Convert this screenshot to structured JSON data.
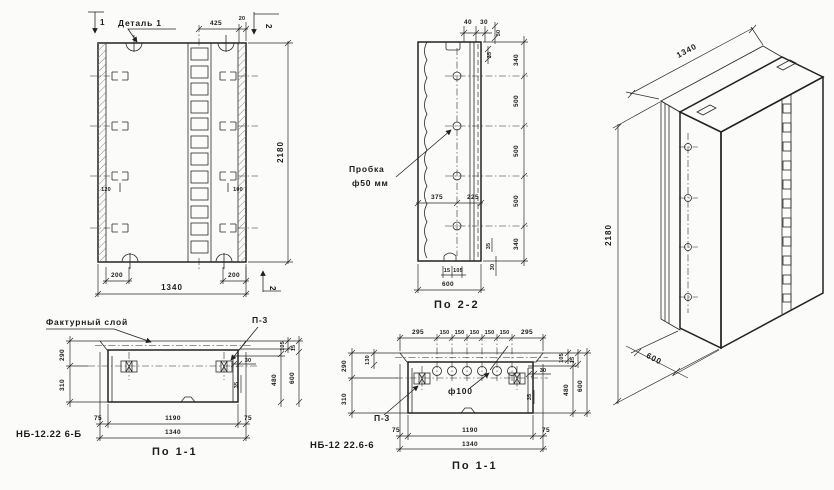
{
  "colors": {
    "ink": "#1f1f1f",
    "paper": "#fbfbfa"
  },
  "elevation": {
    "detail_callout": "Деталь 1",
    "dim_425": "425",
    "dim_20": "20",
    "mark_1": "1",
    "mark_2_top": "2",
    "mark_2_bottom": "2",
    "dim_height": "2180",
    "dim_200_left": "200",
    "dim_200_right": "200",
    "dim_width": "1340",
    "anchor_left": "120",
    "anchor_right": "100"
  },
  "section_2_2": {
    "title": "По 2-2",
    "plug_line1": "Пробка",
    "plug_line2": "ф50 мм",
    "dim_40": "40",
    "dim_30_top": "30",
    "dim_30_right": "30",
    "dim_35_right": "35",
    "chain": [
      "340",
      "500",
      "500",
      "500",
      "340"
    ],
    "dim_375": "375",
    "dim_225": "225",
    "dim_15": "15",
    "dim_105": "105",
    "dim_35_bot": "35",
    "dim_30_bot": "30",
    "dim_600": "600"
  },
  "section_1_1_b": {
    "model": "НБ-12.22 6-Б",
    "title": "По 1-1",
    "facing_callout": "Фактурный слой",
    "p3": "П-3",
    "dim_290": "290",
    "dim_310": "310",
    "dim_105": "105",
    "dim_15": "15",
    "dim_30": "30",
    "dim_35": "35",
    "dim_480": "480",
    "dim_600": "600",
    "dim_75_left": "75",
    "dim_1190": "1190",
    "dim_75_right": "75",
    "dim_1340": "1340"
  },
  "section_1_1_6": {
    "model": "НБ-12 22.6-6",
    "title": "По 1-1",
    "p3": "П-3",
    "hole": "ф100",
    "chain": [
      "295",
      "150",
      "150",
      "150",
      "150",
      "150",
      "295"
    ],
    "dim_290": "290",
    "dim_130": "130",
    "dim_310": "310",
    "dim_105": "105",
    "dim_15": "15",
    "dim_30": "30",
    "dim_35": "35",
    "dim_480": "480",
    "dim_600": "600",
    "dim_75_left": "75",
    "dim_1190": "1190",
    "dim_75_right": "75",
    "dim_1340": "1340"
  },
  "isometric": {
    "dim_width": "1340",
    "dim_height": "2180",
    "dim_depth": "600"
  }
}
